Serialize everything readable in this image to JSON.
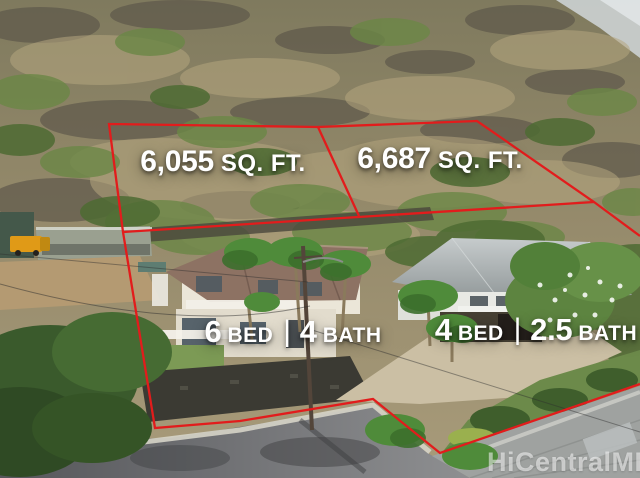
{
  "boundary": {
    "color": "#e21c1c"
  },
  "lots": [
    {
      "area_value": "6,055",
      "area_unit": "SQ. FT."
    },
    {
      "area_value": "6,687",
      "area_unit": "SQ. FT."
    }
  ],
  "houses": [
    {
      "beds": "6",
      "beds_label": "BED",
      "separator": "|",
      "baths": "4",
      "baths_label": "BATH"
    },
    {
      "beds": "4",
      "beds_label": "BED",
      "separator": "|",
      "baths": "2.5",
      "baths_label": "BATH"
    }
  ],
  "watermark": {
    "text": "HiCentralMLS"
  }
}
